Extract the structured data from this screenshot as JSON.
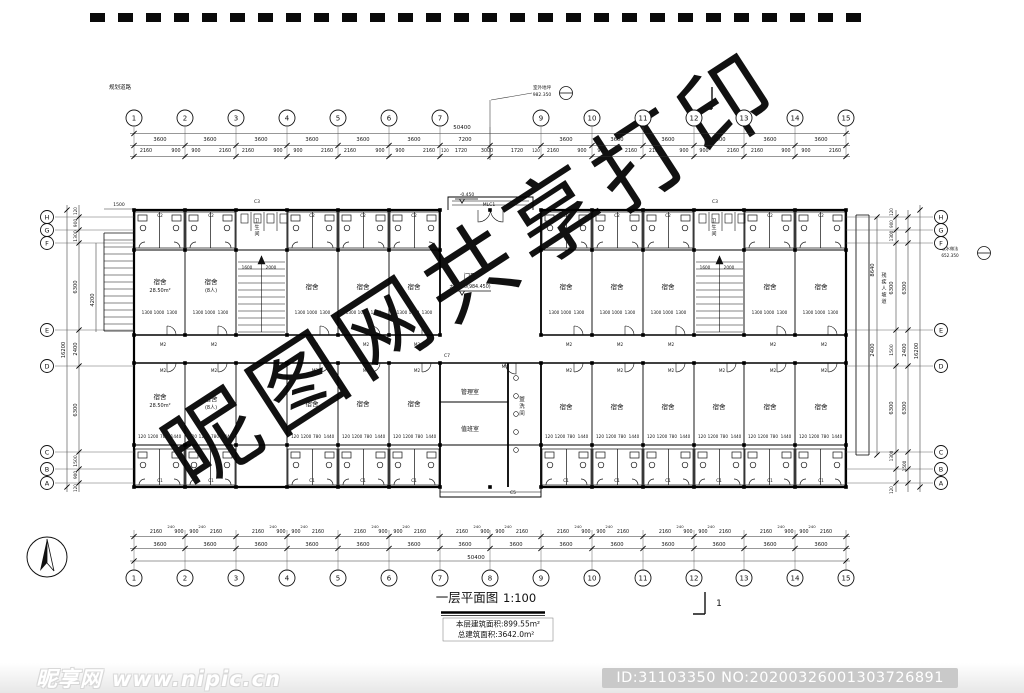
{
  "page": {
    "watermark": "昵图网共享打印"
  },
  "footer": {
    "logo": "昵享网",
    "site": "www.nipic.cn",
    "id_text": "ID:31103350 NO:20200326001303726891"
  },
  "titleblock": {
    "title": "一层平面图",
    "scale": "1:100",
    "area1": "本层建筑面积:899.55m²",
    "area2": "总建筑面积:3642.0m²"
  },
  "grid": {
    "top": {
      "y": 118,
      "items": [
        {
          "n": "1",
          "x": 134
        },
        {
          "n": "2",
          "x": 185
        },
        {
          "n": "3",
          "x": 236
        },
        {
          "n": "4",
          "x": 287
        },
        {
          "n": "5",
          "x": 338
        },
        {
          "n": "6",
          "x": 389
        },
        {
          "n": "7",
          "x": 440
        },
        {
          "n": "9",
          "x": 541
        },
        {
          "n": "10",
          "x": 592
        },
        {
          "n": "11",
          "x": 643
        },
        {
          "n": "12",
          "x": 694
        },
        {
          "n": "13",
          "x": 744
        },
        {
          "n": "14",
          "x": 795
        },
        {
          "n": "15",
          "x": 846
        }
      ]
    },
    "bottom": {
      "y": 578,
      "items": [
        {
          "n": "1",
          "x": 134
        },
        {
          "n": "2",
          "x": 185
        },
        {
          "n": "3",
          "x": 236
        },
        {
          "n": "4",
          "x": 287
        },
        {
          "n": "5",
          "x": 338
        },
        {
          "n": "6",
          "x": 389
        },
        {
          "n": "7",
          "x": 440
        },
        {
          "n": "8",
          "x": 490
        },
        {
          "n": "9",
          "x": 541
        },
        {
          "n": "10",
          "x": 592
        },
        {
          "n": "11",
          "x": 643
        },
        {
          "n": "12",
          "x": 694
        },
        {
          "n": "13",
          "x": 744
        },
        {
          "n": "14",
          "x": 795
        },
        {
          "n": "15",
          "x": 846
        }
      ]
    },
    "left": {
      "x": 47,
      "items": [
        {
          "n": "H",
          "y": 217
        },
        {
          "n": "G",
          "y": 230
        },
        {
          "n": "F",
          "y": 243
        },
        {
          "n": "E",
          "y": 330
        },
        {
          "n": "D",
          "y": 366
        },
        {
          "n": "C",
          "y": 452
        },
        {
          "n": "B",
          "y": 469
        },
        {
          "n": "A",
          "y": 483
        }
      ]
    },
    "right": {
      "x": 941,
      "items": [
        {
          "n": "H",
          "y": 217
        },
        {
          "n": "G",
          "y": 230
        },
        {
          "n": "F",
          "y": 243
        },
        {
          "n": "E",
          "y": 330
        },
        {
          "n": "D",
          "y": 366
        },
        {
          "n": "C",
          "y": 452
        },
        {
          "n": "B",
          "y": 469
        },
        {
          "n": "A",
          "y": 483
        }
      ]
    }
  },
  "tag_rows": [
    {
      "t": "M2",
      "y": 346,
      "s": 4.2,
      "xs": [
        163,
        214,
        315,
        366,
        417,
        569,
        620,
        671,
        773,
        824
      ]
    },
    {
      "t": "M2",
      "y": 372,
      "s": 4.2,
      "xs": [
        163,
        214,
        315,
        366,
        417,
        569,
        620,
        671,
        722,
        773,
        824
      ]
    },
    {
      "t": "C2",
      "y": 217,
      "s": 4.2,
      "xs": [
        160,
        211,
        312,
        363,
        414,
        566,
        617,
        668,
        770,
        821
      ]
    },
    {
      "t": "C1",
      "y": 482,
      "s": 4.2,
      "xs": [
        160,
        211,
        312,
        363,
        414,
        566,
        617,
        668,
        719,
        770,
        821
      ]
    }
  ],
  "row_patterns": [
    {
      "y": 314,
      "s": 4.2,
      "xs": [
        134,
        185,
        287,
        338,
        389,
        541,
        592,
        643,
        744,
        795
      ],
      "items": [
        {
          "o": 13,
          "t": "1300"
        },
        {
          "o": 25,
          "t": "1000"
        },
        {
          "o": 38,
          "t": "1300"
        }
      ]
    },
    {
      "y": 438,
      "s": 4.2,
      "xs": [
        134,
        185,
        287,
        338,
        389,
        541,
        592,
        643,
        694,
        744,
        795
      ],
      "items": [
        {
          "o": 8,
          "t": "120"
        },
        {
          "o": 19,
          "t": "1200"
        },
        {
          "o": 30,
          "t": "780"
        },
        {
          "o": 42,
          "t": "1440"
        }
      ]
    }
  ],
  "texts": [
    {
      "t": "50400",
      "x": 462,
      "y": 129,
      "s": 5.5
    },
    {
      "t": "3600",
      "x": 160,
      "y": 141
    },
    {
      "t": "3600",
      "x": 210,
      "y": 141
    },
    {
      "t": "3600",
      "x": 261,
      "y": 141
    },
    {
      "t": "3600",
      "x": 312,
      "y": 141
    },
    {
      "t": "3600",
      "x": 363,
      "y": 141
    },
    {
      "t": "3600",
      "x": 414,
      "y": 141
    },
    {
      "t": "7200",
      "x": 465,
      "y": 141
    },
    {
      "t": "3600",
      "x": 566,
      "y": 141
    },
    {
      "t": "3600",
      "x": 617,
      "y": 141
    },
    {
      "t": "3600",
      "x": 668,
      "y": 141
    },
    {
      "t": "3600",
      "x": 719,
      "y": 141
    },
    {
      "t": "3600",
      "x": 770,
      "y": 141
    },
    {
      "t": "3600",
      "x": 821,
      "y": 141
    },
    {
      "t": "2160",
      "x": 146,
      "y": 152,
      "s": 4.8
    },
    {
      "t": "900",
      "x": 176,
      "y": 152,
      "s": 4.8
    },
    {
      "t": "900",
      "x": 196,
      "y": 152,
      "s": 4.8
    },
    {
      "t": "2160",
      "x": 225,
      "y": 152,
      "s": 4.8
    },
    {
      "t": "2160",
      "x": 248,
      "y": 152,
      "s": 4.8
    },
    {
      "t": "900",
      "x": 278,
      "y": 152,
      "s": 4.8
    },
    {
      "t": "900",
      "x": 298,
      "y": 152,
      "s": 4.8
    },
    {
      "t": "2160",
      "x": 327,
      "y": 152,
      "s": 4.8
    },
    {
      "t": "2160",
      "x": 350,
      "y": 152,
      "s": 4.8
    },
    {
      "t": "900",
      "x": 380,
      "y": 152,
      "s": 4.8
    },
    {
      "t": "900",
      "x": 400,
      "y": 152,
      "s": 4.8
    },
    {
      "t": "2160",
      "x": 429,
      "y": 152,
      "s": 4.8
    },
    {
      "t": "120",
      "x": 445,
      "y": 152,
      "s": 4
    },
    {
      "t": "1720",
      "x": 461,
      "y": 152,
      "s": 4.8
    },
    {
      "t": "3000",
      "x": 487,
      "y": 152,
      "s": 4.8
    },
    {
      "t": "1720",
      "x": 517,
      "y": 152,
      "s": 4.8
    },
    {
      "t": "120",
      "x": 536,
      "y": 152,
      "s": 4
    },
    {
      "t": "2160",
      "x": 553,
      "y": 152,
      "s": 4.8
    },
    {
      "t": "900",
      "x": 582,
      "y": 152,
      "s": 4.8
    },
    {
      "t": "900",
      "x": 602,
      "y": 152,
      "s": 4.8
    },
    {
      "t": "2160",
      "x": 631,
      "y": 152,
      "s": 4.8
    },
    {
      "t": "2160",
      "x": 655,
      "y": 152,
      "s": 4.8
    },
    {
      "t": "900",
      "x": 684,
      "y": 152,
      "s": 4.8
    },
    {
      "t": "900",
      "x": 704,
      "y": 152,
      "s": 4.8
    },
    {
      "t": "2160",
      "x": 733,
      "y": 152,
      "s": 4.8
    },
    {
      "t": "2160",
      "x": 757,
      "y": 152,
      "s": 4.8
    },
    {
      "t": "900",
      "x": 786,
      "y": 152,
      "s": 4.8
    },
    {
      "t": "900",
      "x": 806,
      "y": 152,
      "s": 4.8
    },
    {
      "t": "2160",
      "x": 835,
      "y": 152,
      "s": 4.8
    },
    {
      "t": "2160",
      "x": 156,
      "y": 533,
      "s": 4.8
    },
    {
      "t": "900",
      "x": 179,
      "y": 533,
      "s": 4.8
    },
    {
      "t": "900",
      "x": 194,
      "y": 533,
      "s": 4.8
    },
    {
      "t": "2160",
      "x": 216,
      "y": 533,
      "s": 4.8
    },
    {
      "t": "2160",
      "x": 258,
      "y": 533,
      "s": 4.8
    },
    {
      "t": "900",
      "x": 281,
      "y": 533,
      "s": 4.8
    },
    {
      "t": "900",
      "x": 296,
      "y": 533,
      "s": 4.8
    },
    {
      "t": "2160",
      "x": 318,
      "y": 533,
      "s": 4.8
    },
    {
      "t": "2160",
      "x": 360,
      "y": 533,
      "s": 4.8
    },
    {
      "t": "900",
      "x": 383,
      "y": 533,
      "s": 4.8
    },
    {
      "t": "900",
      "x": 398,
      "y": 533,
      "s": 4.8
    },
    {
      "t": "2160",
      "x": 420,
      "y": 533,
      "s": 4.8
    },
    {
      "t": "2160",
      "x": 462,
      "y": 533,
      "s": 4.8
    },
    {
      "t": "900",
      "x": 485,
      "y": 533,
      "s": 4.8
    },
    {
      "t": "900",
      "x": 500,
      "y": 533,
      "s": 4.8
    },
    {
      "t": "2160",
      "x": 522,
      "y": 533,
      "s": 4.8
    },
    {
      "t": "2160",
      "x": 563,
      "y": 533,
      "s": 4.8
    },
    {
      "t": "900",
      "x": 586,
      "y": 533,
      "s": 4.8
    },
    {
      "t": "900",
      "x": 601,
      "y": 533,
      "s": 4.8
    },
    {
      "t": "2160",
      "x": 623,
      "y": 533,
      "s": 4.8
    },
    {
      "t": "2160",
      "x": 665,
      "y": 533,
      "s": 4.8
    },
    {
      "t": "900",
      "x": 688,
      "y": 533,
      "s": 4.8
    },
    {
      "t": "900",
      "x": 703,
      "y": 533,
      "s": 4.8
    },
    {
      "t": "2160",
      "x": 725,
      "y": 533,
      "s": 4.8
    },
    {
      "t": "2160",
      "x": 766,
      "y": 533,
      "s": 4.8
    },
    {
      "t": "900",
      "x": 789,
      "y": 533,
      "s": 4.8
    },
    {
      "t": "900",
      "x": 804,
      "y": 533,
      "s": 4.8
    },
    {
      "t": "2160",
      "x": 826,
      "y": 533,
      "s": 4.8
    },
    {
      "t": "240",
      "x": 171,
      "y": 528,
      "s": 3.8
    },
    {
      "t": "240",
      "x": 202,
      "y": 528,
      "s": 3.8
    },
    {
      "t": "240",
      "x": 273,
      "y": 528,
      "s": 3.8
    },
    {
      "t": "240",
      "x": 304,
      "y": 528,
      "s": 3.8
    },
    {
      "t": "240",
      "x": 375,
      "y": 528,
      "s": 3.8
    },
    {
      "t": "240",
      "x": 406,
      "y": 528,
      "s": 3.8
    },
    {
      "t": "240",
      "x": 477,
      "y": 528,
      "s": 3.8
    },
    {
      "t": "240",
      "x": 508,
      "y": 528,
      "s": 3.8
    },
    {
      "t": "240",
      "x": 578,
      "y": 528,
      "s": 3.8
    },
    {
      "t": "240",
      "x": 609,
      "y": 528,
      "s": 3.8
    },
    {
      "t": "240",
      "x": 680,
      "y": 528,
      "s": 3.8
    },
    {
      "t": "240",
      "x": 711,
      "y": 528,
      "s": 3.8
    },
    {
      "t": "240",
      "x": 781,
      "y": 528,
      "s": 3.8
    },
    {
      "t": "240",
      "x": 812,
      "y": 528,
      "s": 3.8
    },
    {
      "t": "3600",
      "x": 160,
      "y": 546
    },
    {
      "t": "3600",
      "x": 210,
      "y": 546
    },
    {
      "t": "3600",
      "x": 261,
      "y": 546
    },
    {
      "t": "3600",
      "x": 312,
      "y": 546
    },
    {
      "t": "3600",
      "x": 363,
      "y": 546
    },
    {
      "t": "3600",
      "x": 414,
      "y": 546
    },
    {
      "t": "3600",
      "x": 465,
      "y": 546
    },
    {
      "t": "3600",
      "x": 516,
      "y": 546
    },
    {
      "t": "3600",
      "x": 566,
      "y": 546
    },
    {
      "t": "3600",
      "x": 617,
      "y": 546
    },
    {
      "t": "3600",
      "x": 668,
      "y": 546
    },
    {
      "t": "3600",
      "x": 719,
      "y": 546
    },
    {
      "t": "3600",
      "x": 770,
      "y": 546
    },
    {
      "t": "3600",
      "x": 821,
      "y": 546
    },
    {
      "t": "50400",
      "x": 476,
      "y": 559,
      "s": 5.5
    },
    {
      "t": "16200",
      "x": 65,
      "y": 350,
      "r": 1
    },
    {
      "t": "120",
      "x": 77,
      "y": 211,
      "r": 1,
      "s": 4
    },
    {
      "t": "900",
      "x": 77,
      "y": 223,
      "r": 1,
      "s": 4.5
    },
    {
      "t": "1300",
      "x": 77,
      "y": 236,
      "r": 1,
      "s": 4.5
    },
    {
      "t": "6300",
      "x": 77,
      "y": 287,
      "r": 1
    },
    {
      "t": "2400",
      "x": 77,
      "y": 349,
      "r": 1
    },
    {
      "t": "6300",
      "x": 77,
      "y": 410,
      "r": 1
    },
    {
      "t": "1500",
      "x": 77,
      "y": 461,
      "r": 1,
      "s": 4.5
    },
    {
      "t": "900",
      "x": 77,
      "y": 475,
      "r": 1,
      "s": 4.2
    },
    {
      "t": "120",
      "x": 77,
      "y": 488,
      "r": 1,
      "s": 4
    },
    {
      "t": "4200",
      "x": 94,
      "y": 300,
      "r": 1
    },
    {
      "t": "1500",
      "x": 119,
      "y": 206,
      "s": 4.5
    },
    {
      "t": "8640",
      "x": 874,
      "y": 270,
      "r": 1
    },
    {
      "t": "2400",
      "x": 874,
      "y": 350,
      "r": 1
    },
    {
      "t": "900",
      "x": 893,
      "y": 224,
      "r": 1,
      "s": 4
    },
    {
      "t": "1300",
      "x": 893,
      "y": 236,
      "r": 1,
      "s": 4.2
    },
    {
      "t": "6300",
      "x": 893,
      "y": 288,
      "r": 1
    },
    {
      "t": "1500",
      "x": 893,
      "y": 350,
      "r": 1,
      "s": 4.5
    },
    {
      "t": "6300",
      "x": 893,
      "y": 408,
      "r": 1
    },
    {
      "t": "1300",
      "x": 893,
      "y": 456,
      "r": 1,
      "s": 4.2
    },
    {
      "t": "120",
      "x": 893,
      "y": 212,
      "r": 1,
      "s": 4
    },
    {
      "t": "120",
      "x": 893,
      "y": 490,
      "r": 1,
      "s": 4
    },
    {
      "t": "6300",
      "x": 906,
      "y": 288,
      "r": 1
    },
    {
      "t": "2400",
      "x": 906,
      "y": 350,
      "r": 1
    },
    {
      "t": "6300",
      "x": 906,
      "y": 408,
      "r": 1
    },
    {
      "t": "1500",
      "x": 906,
      "y": 466,
      "r": 1,
      "s": 4.2
    },
    {
      "t": "16200",
      "x": 918,
      "y": 351,
      "r": 1
    },
    {
      "t": "1600",
      "x": 247,
      "y": 269,
      "s": 4.2
    },
    {
      "t": "2000",
      "x": 271,
      "y": 269,
      "s": 4.2
    },
    {
      "t": "1600",
      "x": 705,
      "y": 269,
      "s": 4.2
    },
    {
      "t": "2000",
      "x": 729,
      "y": 269,
      "s": 4.2
    },
    {
      "t": "C3",
      "x": 257,
      "y": 203,
      "s": 4.5
    },
    {
      "t": "C3",
      "x": 715,
      "y": 203,
      "s": 4.5
    },
    {
      "t": "C5",
      "x": 513,
      "y": 494,
      "s": 4.5
    },
    {
      "t": "C7",
      "x": 447,
      "y": 357,
      "s": 4.5
    },
    {
      "t": "M4",
      "x": 505,
      "y": 368,
      "s": 4.5
    },
    {
      "t": "MLC1",
      "x": 489,
      "y": 206,
      "s": 4.5
    },
    {
      "t": "-0.450",
      "x": 467,
      "y": 196,
      "s": 4.5
    },
    {
      "t": "宿舍",
      "x": 160,
      "y": 284,
      "s": 6.5
    },
    {
      "t": "28.50m²",
      "x": 160,
      "y": 292,
      "s": 5
    },
    {
      "t": "宿舍",
      "x": 211,
      "y": 284,
      "s": 6.5
    },
    {
      "t": "(8人)",
      "x": 211,
      "y": 292,
      "s": 5
    },
    {
      "t": "宿舍",
      "x": 312,
      "y": 289,
      "s": 6.5
    },
    {
      "t": "宿舍",
      "x": 363,
      "y": 289,
      "s": 6.5
    },
    {
      "t": "宿舍",
      "x": 414,
      "y": 289,
      "s": 6.5
    },
    {
      "t": "宿舍",
      "x": 566,
      "y": 289,
      "s": 6.5
    },
    {
      "t": "宿舍",
      "x": 617,
      "y": 289,
      "s": 6.5
    },
    {
      "t": "宿舍",
      "x": 668,
      "y": 289,
      "s": 6.5
    },
    {
      "t": "宿舍",
      "x": 770,
      "y": 289,
      "s": 6.5
    },
    {
      "t": "宿舍",
      "x": 821,
      "y": 289,
      "s": 6.5
    },
    {
      "t": "宿舍",
      "x": 160,
      "y": 399,
      "s": 6.5
    },
    {
      "t": "28.50m²",
      "x": 160,
      "y": 407,
      "s": 5
    },
    {
      "t": "宿舍",
      "x": 211,
      "y": 401,
      "s": 6.5
    },
    {
      "t": "(8人)",
      "x": 211,
      "y": 409,
      "s": 5
    },
    {
      "t": "宿舍",
      "x": 312,
      "y": 406,
      "s": 6.5
    },
    {
      "t": "宿舍",
      "x": 363,
      "y": 406,
      "s": 6.5
    },
    {
      "t": "宿舍",
      "x": 414,
      "y": 406,
      "s": 6.5
    },
    {
      "t": "宿舍",
      "x": 566,
      "y": 409,
      "s": 6.5
    },
    {
      "t": "宿舍",
      "x": 617,
      "y": 409,
      "s": 6.5
    },
    {
      "t": "宿舍",
      "x": 668,
      "y": 409,
      "s": 6.5
    },
    {
      "t": "宿舍",
      "x": 719,
      "y": 409,
      "s": 6.5
    },
    {
      "t": "宿舍",
      "x": 770,
      "y": 409,
      "s": 6.5
    },
    {
      "t": "宿舍",
      "x": 821,
      "y": 409,
      "s": 6.5
    },
    {
      "t": "管理室",
      "x": 470,
      "y": 394,
      "s": 6
    },
    {
      "t": "值班室",
      "x": 470,
      "y": 431,
      "s": 6
    },
    {
      "t": "盥洗间",
      "x": 522,
      "y": 408,
      "v": 1,
      "s": 5.5
    },
    {
      "t": "卫生间",
      "x": 257,
      "y": 229,
      "v": 1,
      "s": 5
    },
    {
      "t": "卫生间",
      "x": 714,
      "y": 229,
      "v": 1,
      "s": 5
    },
    {
      "t": "门厅",
      "x": 470,
      "y": 278,
      "s": 6.5
    },
    {
      "t": "±0.000(984.450)",
      "x": 470,
      "y": 288,
      "s": 4.8
    },
    {
      "t": "残疾人坡道",
      "x": 884,
      "y": 290,
      "v": 1,
      "s": 5
    },
    {
      "t": "规划道路",
      "x": 120,
      "y": 89,
      "s": 5.5
    },
    {
      "t": "室外地坪",
      "x": 542,
      "y": 89,
      "s": 4.5
    },
    {
      "t": "982.350",
      "x": 542,
      "y": 96,
      "s": 4.5
    },
    {
      "t": "散水做法",
      "x": 950,
      "y": 250,
      "s": 4.2
    },
    {
      "t": "652.350",
      "x": 950,
      "y": 257,
      "s": 4.2
    },
    {
      "t": "1",
      "x": 726,
      "y": 97,
      "s": 9
    },
    {
      "t": "1",
      "x": 719,
      "y": 606,
      "s": 9
    }
  ]
}
